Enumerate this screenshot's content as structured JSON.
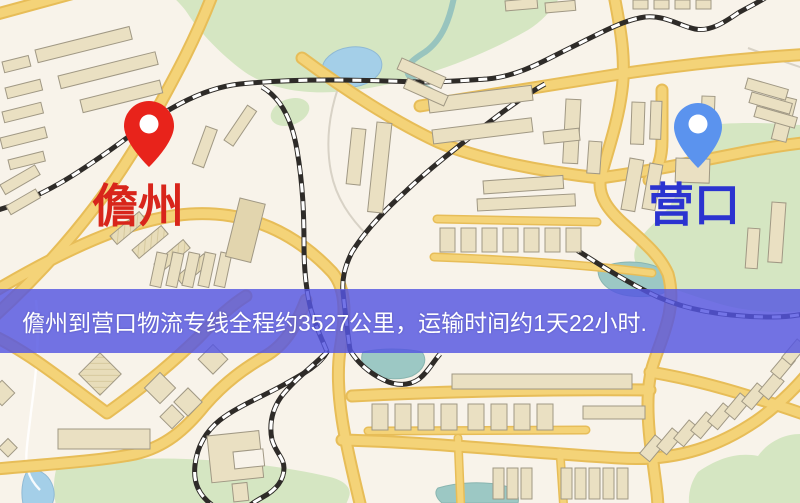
{
  "banner": {
    "text": "儋州到营口物流专线全程约3527公里，运输时间约1天22小时.",
    "background_color": "#5456e2",
    "text_color": "#ffffff"
  },
  "origin": {
    "label": "儋州",
    "label_color": "#d8251b",
    "pin_color": "#e8231b"
  },
  "destination": {
    "label": "营口",
    "label_color": "#2b33d0",
    "pin_color": "#5b93ee"
  },
  "map_palette": {
    "background": "#f8f3ea",
    "road_fill": "#f4d378",
    "road_casing": "#e7bd58",
    "building_fill": "#eae0c2",
    "building_outline": "#a09884",
    "park_green": "#d5e6c2",
    "water_blue": "#a4cfe8",
    "water_teal": "#9cc8c4",
    "railway_dark": "#2e2b28"
  }
}
